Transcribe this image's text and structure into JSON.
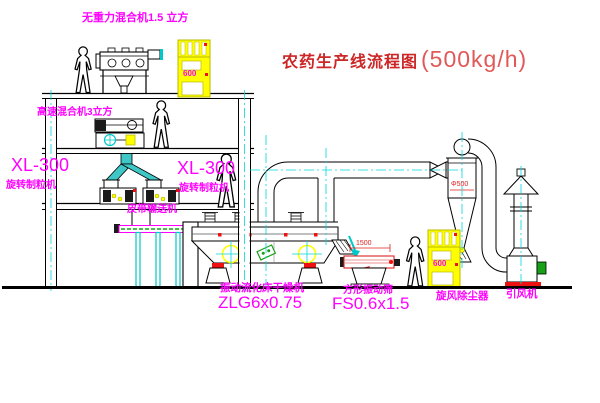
{
  "title": {
    "main": "农药生产线流程图",
    "capacity": "(500kg/h)"
  },
  "labels": {
    "top_mixer": "无重力混合机1.5 立方",
    "second_mixer": "高速混合机3立方",
    "granulator_left_model": "XL-300",
    "granulator_left_name": "旋转制粒机",
    "granulator_right_model": "XL-300",
    "granulator_right_name": "旋转制粒机",
    "belt_conveyor": "皮带输送机",
    "dryer_name": "振动流化床干燥机",
    "dryer_model": "ZLG6x0.75",
    "sieve_name": "方形振动筛",
    "sieve_model": "FS0.6x1.5",
    "cyclone_name": "旋风除尘器",
    "fan_name": "引风机"
  },
  "dimensions": {
    "sieve_width": "1500",
    "cyclone_diameter": "Φ500"
  },
  "cabinets": {
    "cabinet1_text": "600",
    "cabinet2_text": "600"
  },
  "colors": {
    "label_magenta": "#ff00ff",
    "title_red": "#cc2626",
    "centerline_cyan": "#00d8d8",
    "machine_yellow": "#ffff00",
    "accent_red": "#ee1111",
    "accent_green": "#18a018",
    "line_black": "#000000"
  }
}
